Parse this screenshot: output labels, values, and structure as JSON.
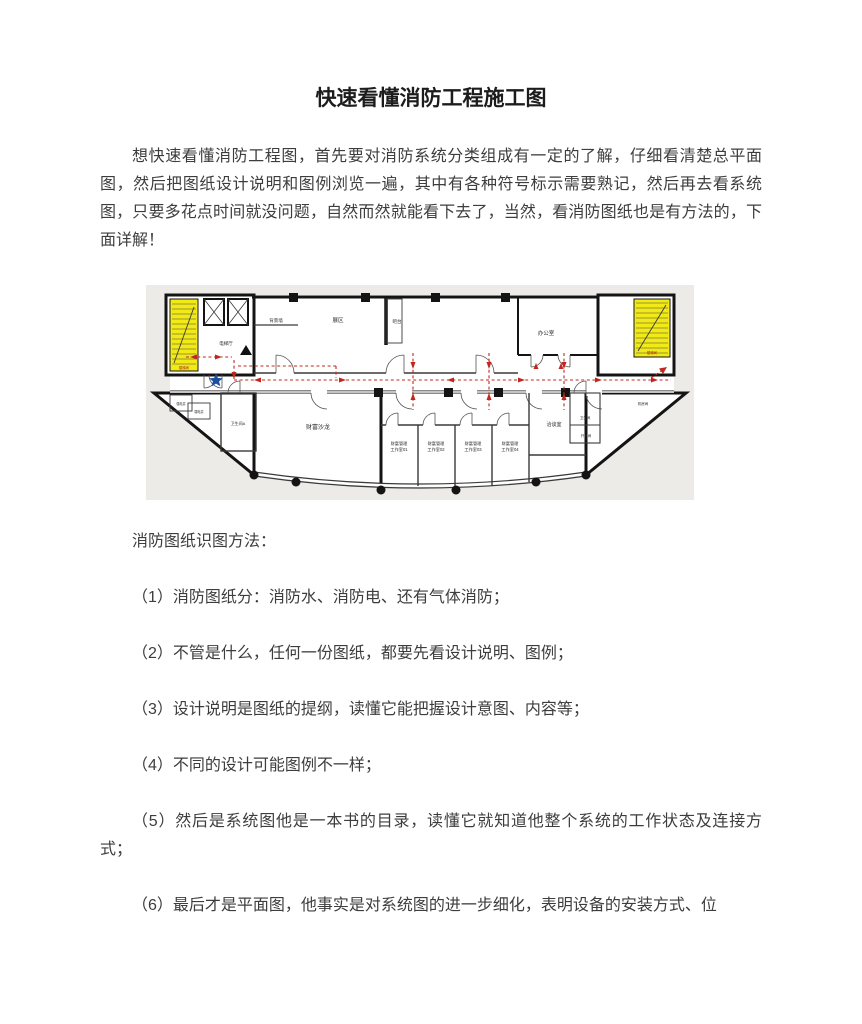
{
  "content": {
    "title": "快速看懂消防工程施工图",
    "intro": "想快速看懂消防工程图，首先要对消防系统分类组成有一定的了解，仔细看清楚总平面图，然后把图纸设计说明和图例浏览一遍，其中有各种符号标示需要熟记，然后再去看系统图，只要多花点时间就没问题，自然而然就能看下去了，当然，看消防图纸也是有方法的，下面详解！",
    "section_heading": "消防图纸识图方法：",
    "items": [
      "（1）消防图纸分：消防水、消防电、还有气体消防；",
      "（2）不管是什么，任何一份图纸，都要先看设计说明、图例；",
      "（3）设计说明是图纸的提纲，读懂它能把握设计意图、内容等；",
      "（4）不同的设计可能图例不一样；",
      "（5）然后是系统图他是一本书的目录，读懂它就知道他整个系统的工作状态及连接方式；",
      "（6）最后才是平面图，他事实是对系统图的进一步细化，表明设备的安装方式、位"
    ]
  },
  "floorplan": {
    "labels": {
      "stair_left": "楼梯间",
      "stair_right": "楼梯间",
      "elevator_hall": "电梯厅",
      "bg_wall": "背景墙",
      "exhibit": "展区",
      "bar": "吧台",
      "office": "办公室",
      "salon": "财富沙龙",
      "toilet_a": "卫生间A",
      "strong_shaft": "强电井",
      "weak_shaft": "弱电井",
      "meeting": "洽谈室",
      "toilet_r": "卫生间",
      "water": "开水间",
      "machine": "机房间",
      "studio_prefix": "财富管理",
      "studios": [
        "工作室01",
        "工作室02",
        "工作室03",
        "工作室04"
      ]
    },
    "colors": {
      "plan_bg": "#ecebe8",
      "wall_black": "#141414",
      "stair_yellow": "#f2ea16",
      "route_red": "#c0271f",
      "star_blue": "#1d4fa0"
    }
  }
}
